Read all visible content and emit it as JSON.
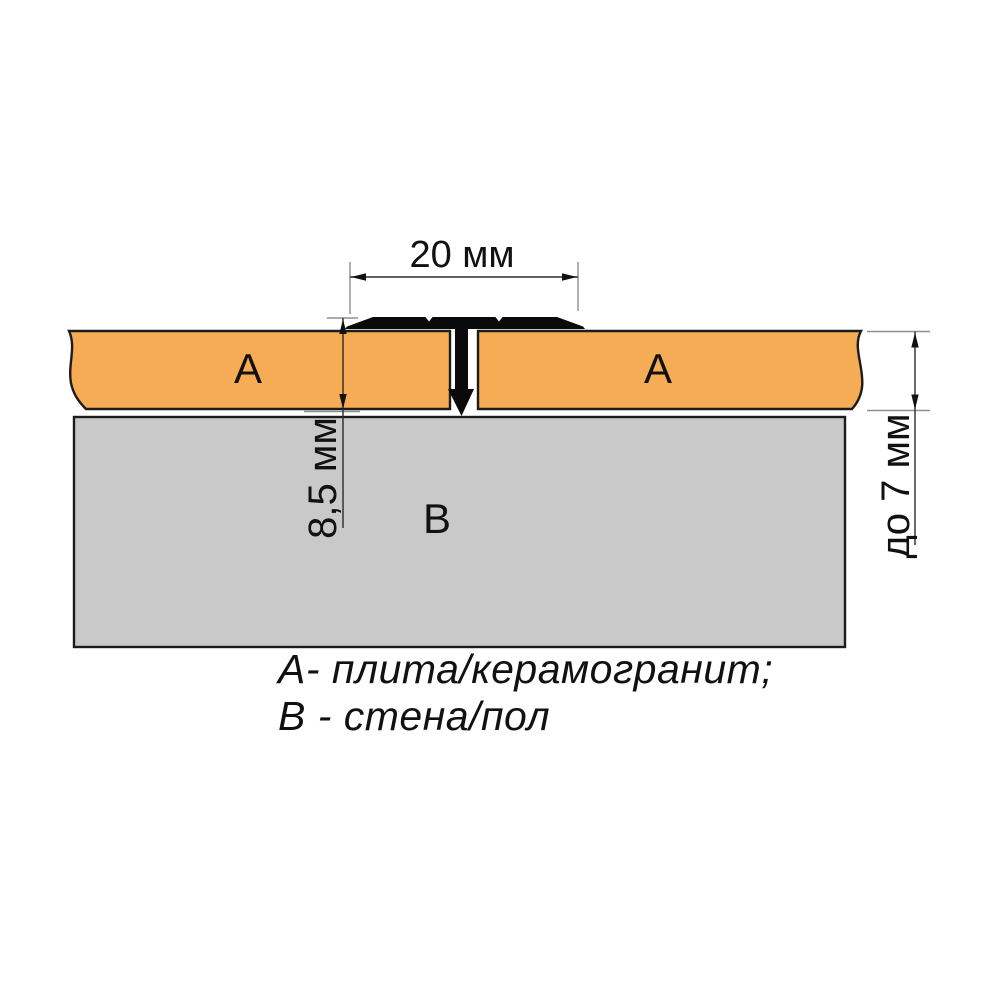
{
  "diagram": {
    "dim_width": "20 мм",
    "dim_profile_height": "8,5 мм",
    "dim_tile_thickness": "до 7 мм",
    "label_tile_left": "А",
    "label_tile_right": "А",
    "label_base": "В"
  },
  "legend": {
    "line1": "А- плита/керамогранит;",
    "line2": "В - стена/пол"
  },
  "colors": {
    "tile": "#F6AB55",
    "base": "#C9C9C9",
    "profile": "#0A0A0A",
    "background": "#FFFFFF"
  }
}
